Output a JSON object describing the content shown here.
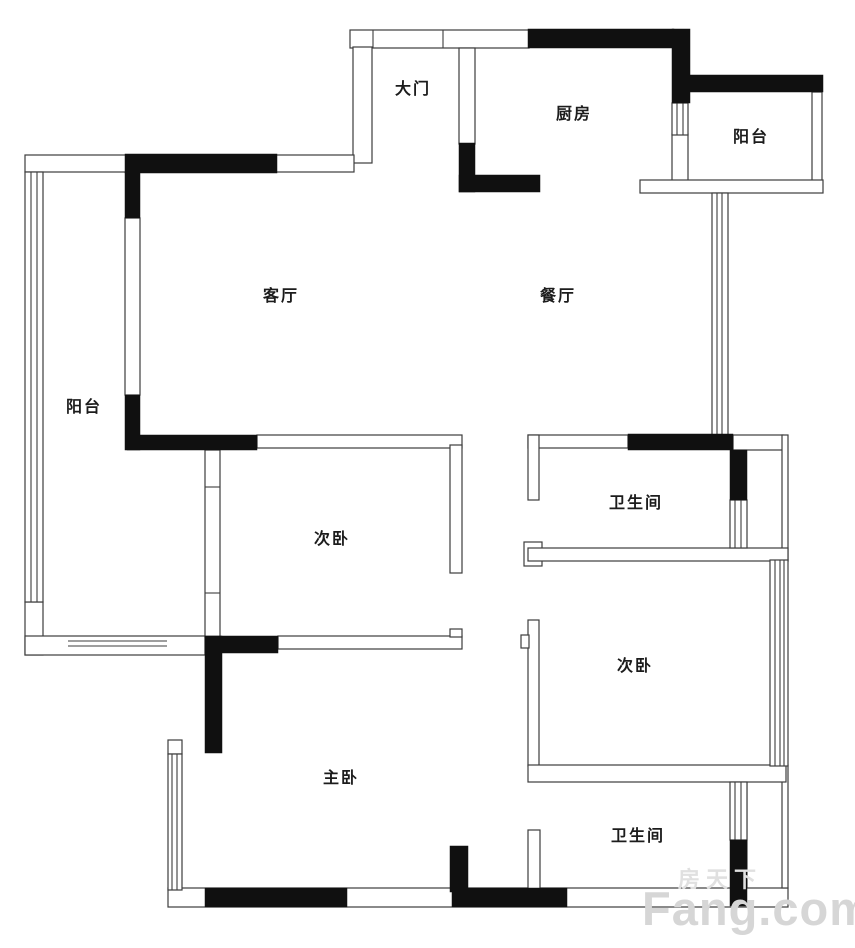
{
  "page": {
    "background": "#ffffff"
  },
  "floorplan": {
    "rooms": [
      {
        "id": "entrance",
        "label": "大门"
      },
      {
        "id": "kitchen",
        "label": "厨房"
      },
      {
        "id": "balcony-north",
        "label": "阳台"
      },
      {
        "id": "living-room",
        "label": "客厅"
      },
      {
        "id": "dining-room",
        "label": "餐厅"
      },
      {
        "id": "balcony-west",
        "label": "阳台"
      },
      {
        "id": "bedroom-second-west",
        "label": "次卧"
      },
      {
        "id": "bathroom-north",
        "label": "卫生间"
      },
      {
        "id": "bedroom-second-east",
        "label": "次卧"
      },
      {
        "id": "master-bedroom",
        "label": "主卧"
      },
      {
        "id": "bathroom-south",
        "label": "卫生间"
      }
    ],
    "watermark": {
      "brand": "Fang.com",
      "brand_cn": "房天下"
    },
    "colors": {
      "wall_fill": "#101010",
      "wall_line": "#3d3d3d",
      "background": "#ffffff",
      "watermark": "#d6d6d6"
    }
  }
}
